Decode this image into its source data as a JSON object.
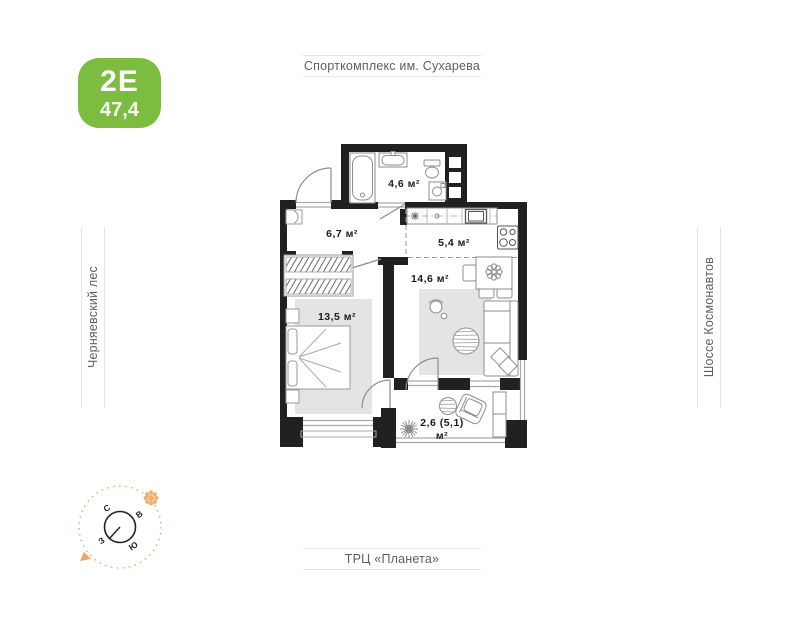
{
  "badge": {
    "type_label": "2Е",
    "area_label": "47,4",
    "color": "#7bbc41"
  },
  "surroundings": {
    "top": "Спорткомплекс им. Сухарева",
    "bottom": "ТРЦ «Планета»",
    "left": "Черняевский лес",
    "right": "Шоссе Космонавтов"
  },
  "rooms": {
    "bathroom": {
      "area": "4,6 м²"
    },
    "hallway": {
      "area": "6,7 м²"
    },
    "kitchen": {
      "area": "5,4 м²"
    },
    "living": {
      "area": "14,6 м²"
    },
    "bedroom": {
      "area": "13,5 м²"
    },
    "balcony": {
      "area_line1": "2,6 (5,1)",
      "area_line2": "м²"
    }
  },
  "compass": {
    "north": "С",
    "east": "В",
    "south": "Ю",
    "west": "З"
  },
  "colors": {
    "accent_green": "#7bbc41",
    "compass_orange": "#eda566",
    "wall": "#212121",
    "rug": "#e4e4e4"
  }
}
